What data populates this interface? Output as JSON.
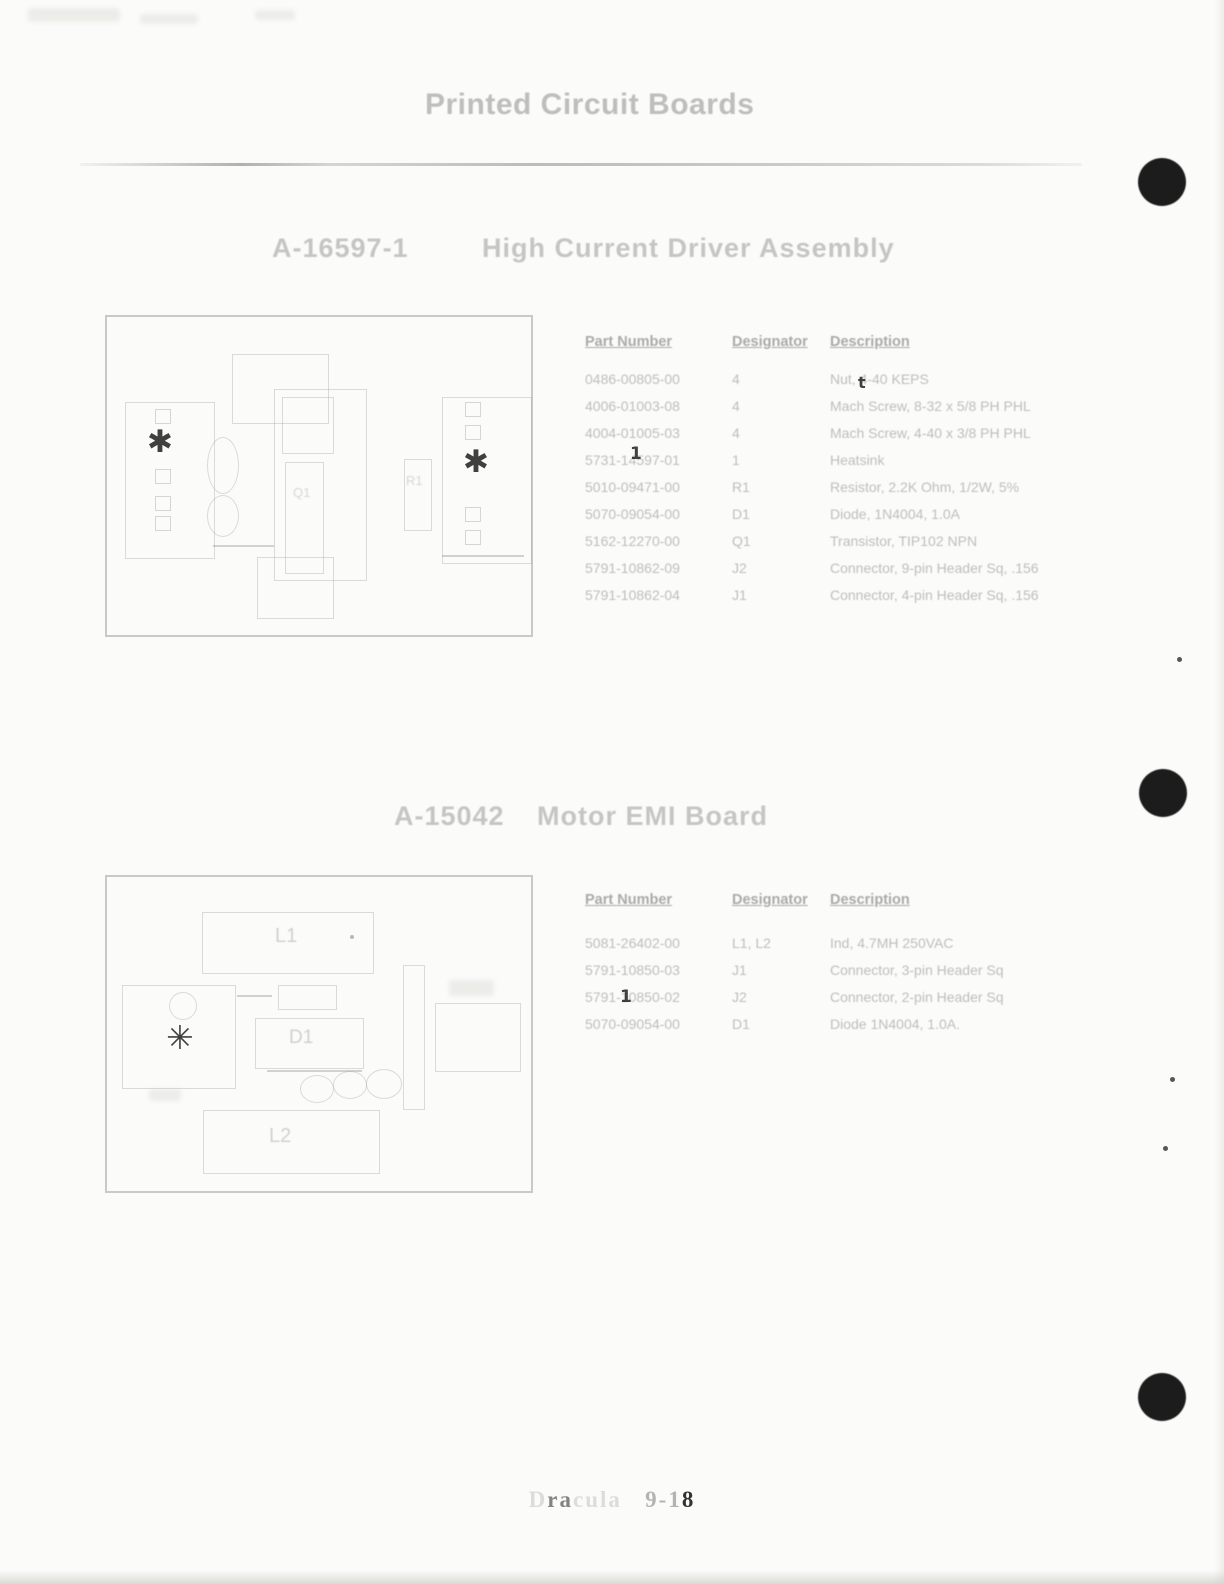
{
  "page": {
    "title": "Printed Circuit Boards",
    "footer_label": "Dracula 9-18"
  },
  "footer": {
    "segments": [
      {
        "text": "D",
        "emph": "faint"
      },
      {
        "text": "ra",
        "emph": "mid"
      },
      {
        "text": "cula",
        "emph": "faint"
      },
      {
        "text": "   ",
        "emph": "faint"
      },
      {
        "text": "9-1",
        "emph": "midlight"
      },
      {
        "text": "8",
        "emph": "dark"
      }
    ]
  },
  "sections": [
    {
      "part_no": "A-16597-1",
      "name": "High Current Driver Assembly",
      "table": {
        "headers": {
          "part": "Part Number",
          "des": "Designator",
          "desc": "Description"
        },
        "rows": [
          {
            "part": "0486-00805-00",
            "des": "4",
            "desc": "Nut, 4-40 KEPS"
          },
          {
            "part": "4006-01003-08",
            "des": "4",
            "desc": "Mach Screw, 8-32 x 5/8 PH PHL"
          },
          {
            "part": "4004-01005-03",
            "des": "4",
            "desc": "Mach Screw, 4-40 x 3/8 PH PHL"
          },
          {
            "part": "5731-14597-01",
            "des": "1",
            "desc": "Heatsink"
          },
          {
            "part": "5010-09471-00",
            "des": "R1",
            "desc": "Resistor, 2.2K Ohm, 1/2W, 5%"
          },
          {
            "part": "5070-09054-00",
            "des": "D1",
            "desc": "Diode, 1N4004, 1.0A"
          },
          {
            "part": "5162-12270-00",
            "des": "Q1",
            "desc": "Transistor, TIP102 NPN"
          },
          {
            "part": "5791-10862-09",
            "des": "J2",
            "desc": "Connector, 9-pin Header Sq, .156"
          },
          {
            "part": "5791-10862-04",
            "des": "J1",
            "desc": "Connector, 4-pin Header Sq, .156"
          }
        ]
      }
    },
    {
      "part_no": "A-15042",
      "name": "Motor EMI Board",
      "table": {
        "headers": {
          "part": "Part Number",
          "des": "Designator",
          "desc": "Description"
        },
        "rows": [
          {
            "part": "5081-26402-00",
            "des": "L1, L2",
            "desc": "Ind, 4.7MH 250VAC"
          },
          {
            "part": "5791-10850-03",
            "des": "J1",
            "desc": "Connector, 3-pin Header Sq"
          },
          {
            "part": "5791-10850-02",
            "des": "J2",
            "desc": "Connector, 2-pin Header Sq"
          },
          {
            "part": "5070-09054-00",
            "des": "D1",
            "desc": "Diode 1N4004, 1.0A."
          }
        ]
      }
    }
  ],
  "boards": {
    "board1_labels": {
      "q1": "Q1",
      "r1": "R1"
    },
    "board2_labels": {
      "l1": "L1",
      "d1": "D1",
      "l2": "L2"
    }
  },
  "scan_artifacts": {
    "hole_color": "#1c1c1c",
    "punch_holes": [
      {
        "x": 1162,
        "y": 182
      },
      {
        "x": 1163,
        "y": 793
      },
      {
        "x": 1162,
        "y": 1397
      }
    ],
    "specks": [
      {
        "x": 1177,
        "y": 657
      },
      {
        "x": 1170,
        "y": 1077
      },
      {
        "x": 1163,
        "y": 1146
      }
    ],
    "dark_glyphs": [
      {
        "glyph": "✱",
        "x": 147,
        "y": 427,
        "size": 31
      },
      {
        "glyph": "✱",
        "x": 463,
        "y": 447,
        "size": 31
      },
      {
        "glyph": "✳",
        "x": 166,
        "y": 1021,
        "size": 33
      },
      {
        "glyph": "1",
        "x": 630,
        "y": 446,
        "size": 17
      },
      {
        "glyph": "t",
        "x": 858,
        "y": 375,
        "size": 16
      },
      {
        "glyph": "1",
        "x": 620,
        "y": 989,
        "size": 17
      }
    ]
  }
}
